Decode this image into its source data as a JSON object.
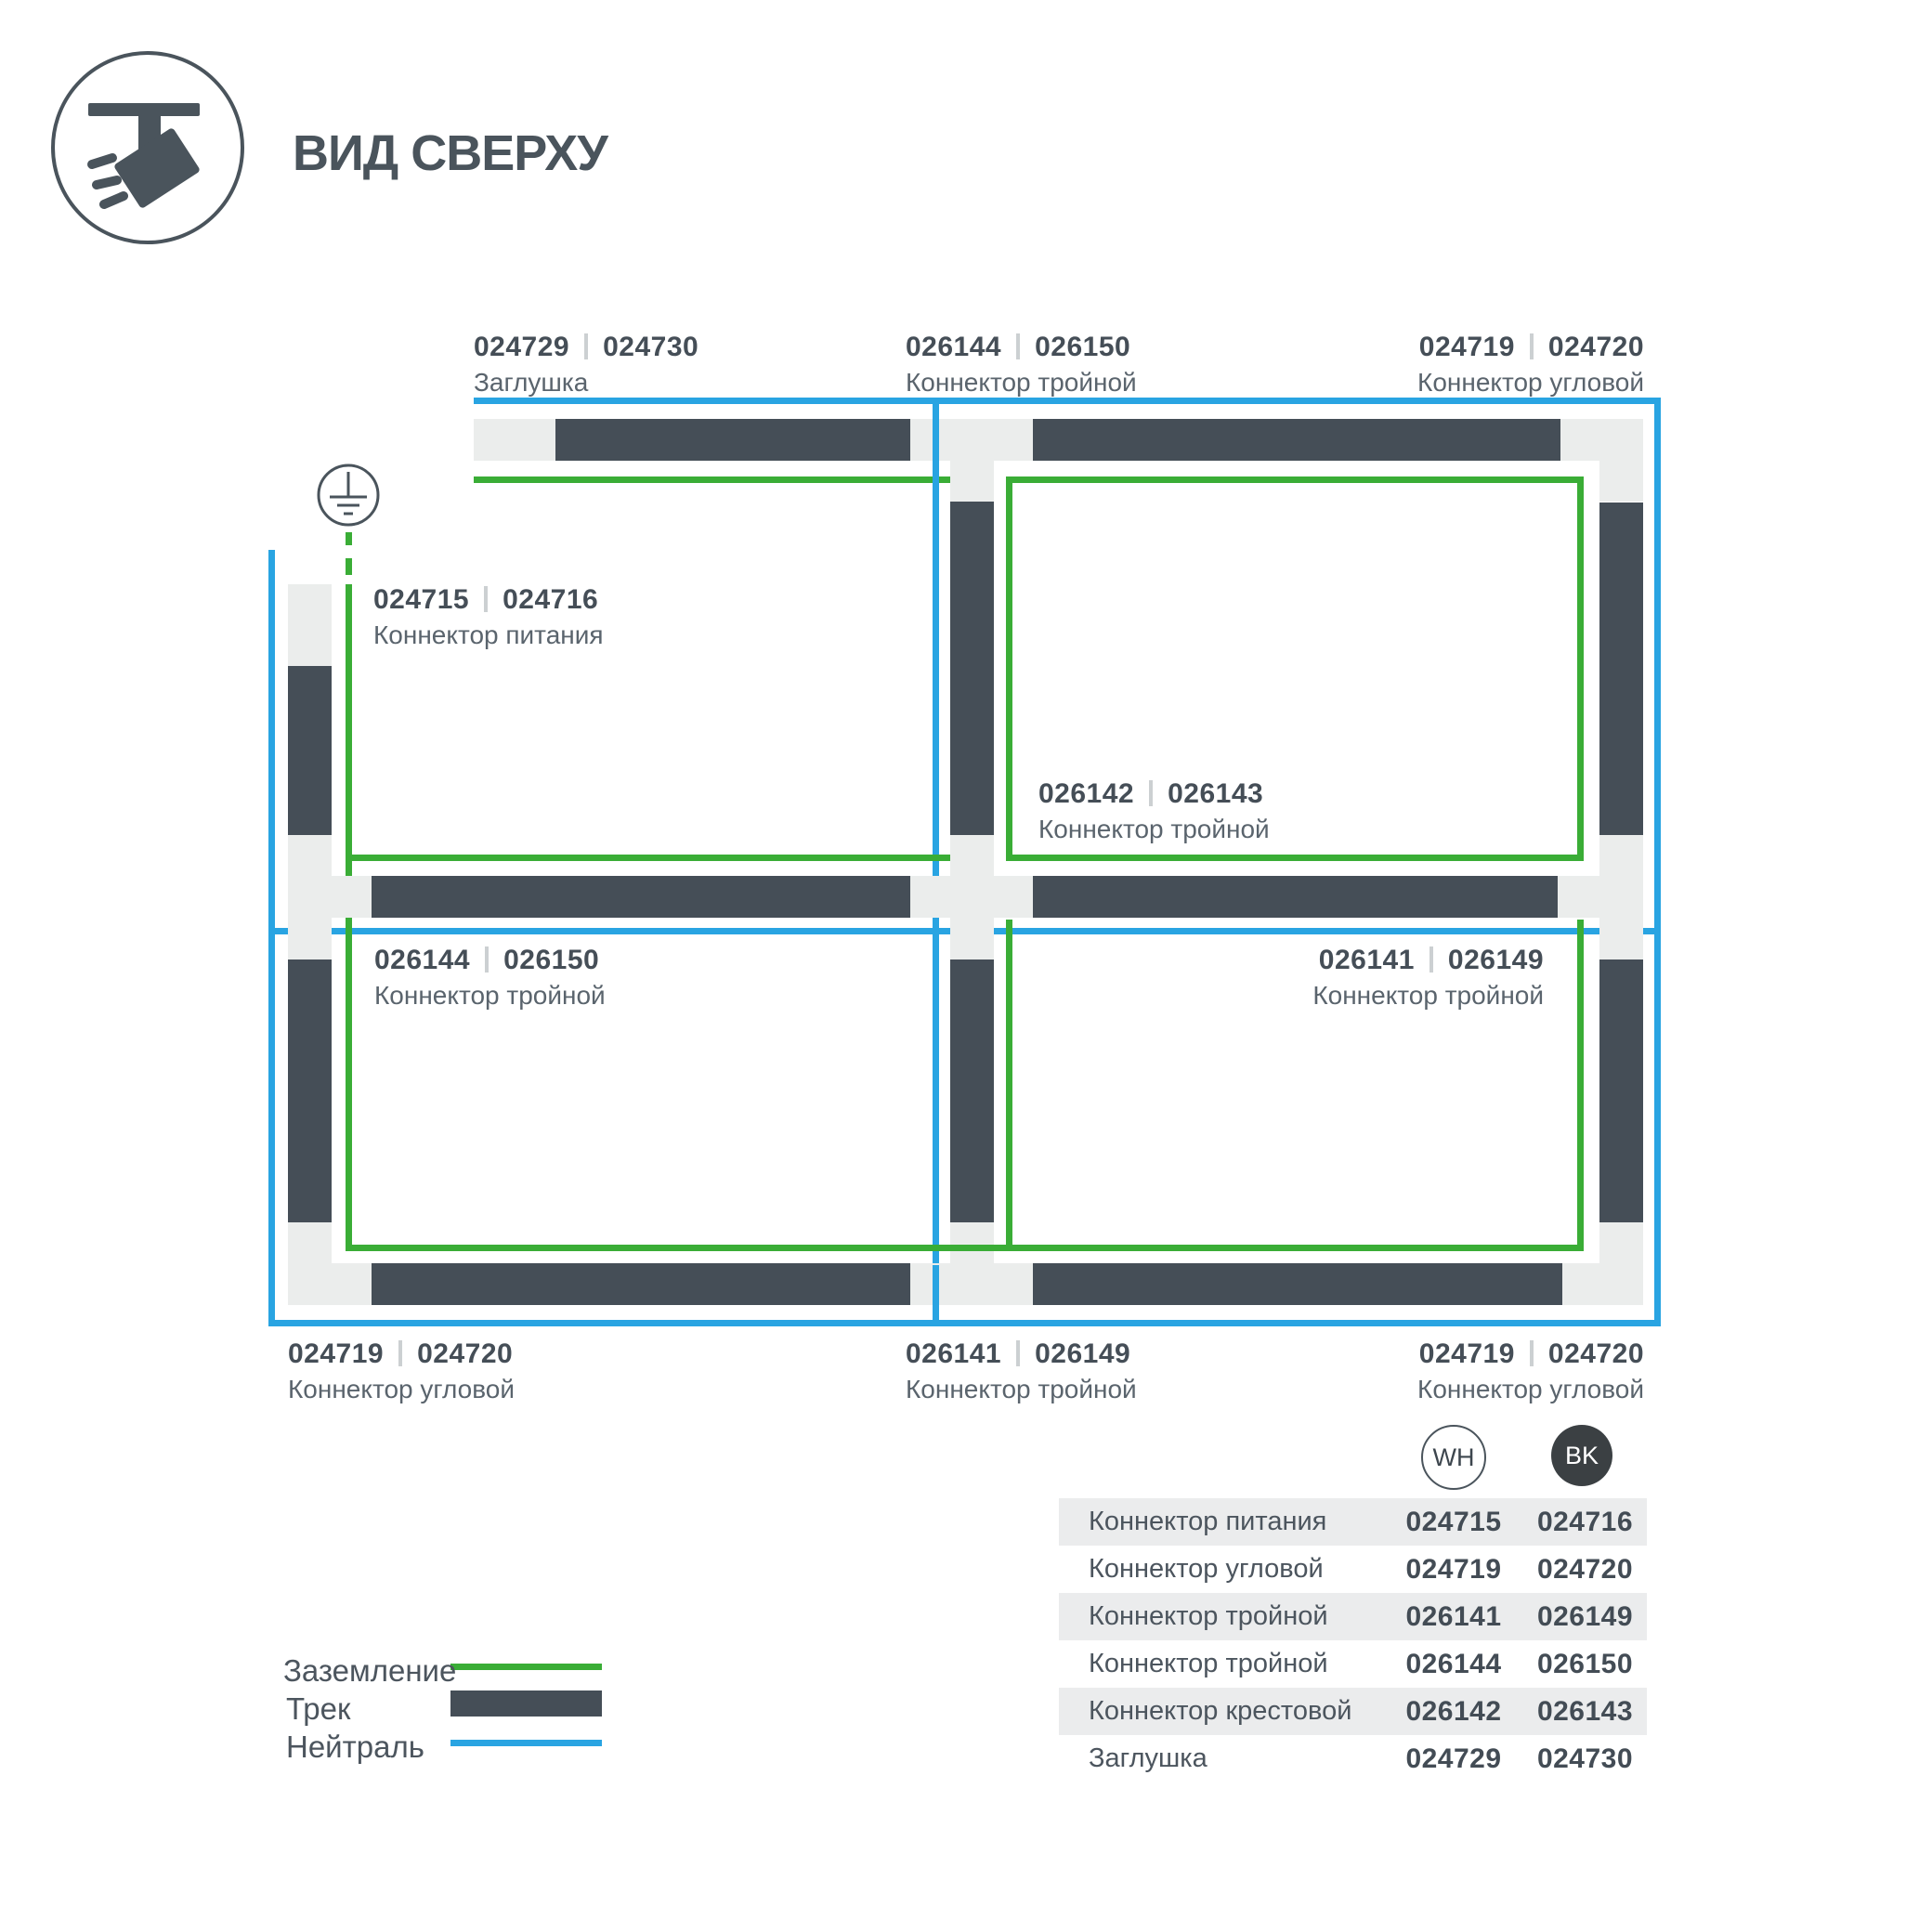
{
  "header": {
    "title": "ВИД СВЕРХУ",
    "icon": "track-spotlight-icon"
  },
  "colors": {
    "track": "#454e57",
    "connector": "#ebedec",
    "ground_green": "#3aad36",
    "neutral_blue": "#29a4e2",
    "text_dark": "#454e57",
    "text_gray": "#5a646d",
    "table_band": "#ebeced",
    "bk_circle": "#3b4043"
  },
  "diagram": {
    "ground_symbol": "earth-ground-icon",
    "labels": {
      "top_left": {
        "code_wh": "024729",
        "code_bk": "024730",
        "name": "Заглушка"
      },
      "top_center": {
        "code_wh": "026144",
        "code_bk": "026150",
        "name": "Коннектор тройной"
      },
      "top_right": {
        "code_wh": "024719",
        "code_bk": "024720",
        "name": "Коннектор угловой"
      },
      "power": {
        "code_wh": "024715",
        "code_bk": "024716",
        "name": "Коннектор питания"
      },
      "center": {
        "code_wh": "026142",
        "code_bk": "026143",
        "name": "Коннектор тройной"
      },
      "mid_left": {
        "code_wh": "026144",
        "code_bk": "026150",
        "name": "Коннектор тройной"
      },
      "mid_right": {
        "code_wh": "026141",
        "code_bk": "026149",
        "name": "Коннектор тройной"
      },
      "bottom_left": {
        "code_wh": "024719",
        "code_bk": "024720",
        "name": "Коннектор угловой"
      },
      "bottom_center": {
        "code_wh": "026141",
        "code_bk": "026149",
        "name": "Коннектор тройной"
      },
      "bottom_right": {
        "code_wh": "024719",
        "code_bk": "024720",
        "name": "Коннектор угловой"
      }
    }
  },
  "legend": {
    "ground": "Заземление",
    "track": "Трек",
    "neutral": "Нейтраль"
  },
  "variants": {
    "wh": "WH",
    "bk": "BK"
  },
  "table": {
    "rows": [
      {
        "name": "Коннектор питания",
        "wh": "024715",
        "bk": "024716"
      },
      {
        "name": "Коннектор угловой",
        "wh": "024719",
        "bk": "024720"
      },
      {
        "name": "Коннектор тройной",
        "wh": "026141",
        "bk": "026149"
      },
      {
        "name": "Коннектор тройной",
        "wh": "026144",
        "bk": "026150"
      },
      {
        "name": "Коннектор крестовой",
        "wh": "026142",
        "bk": "026143"
      },
      {
        "name": "Заглушка",
        "wh": "024729",
        "bk": "024730"
      }
    ]
  }
}
